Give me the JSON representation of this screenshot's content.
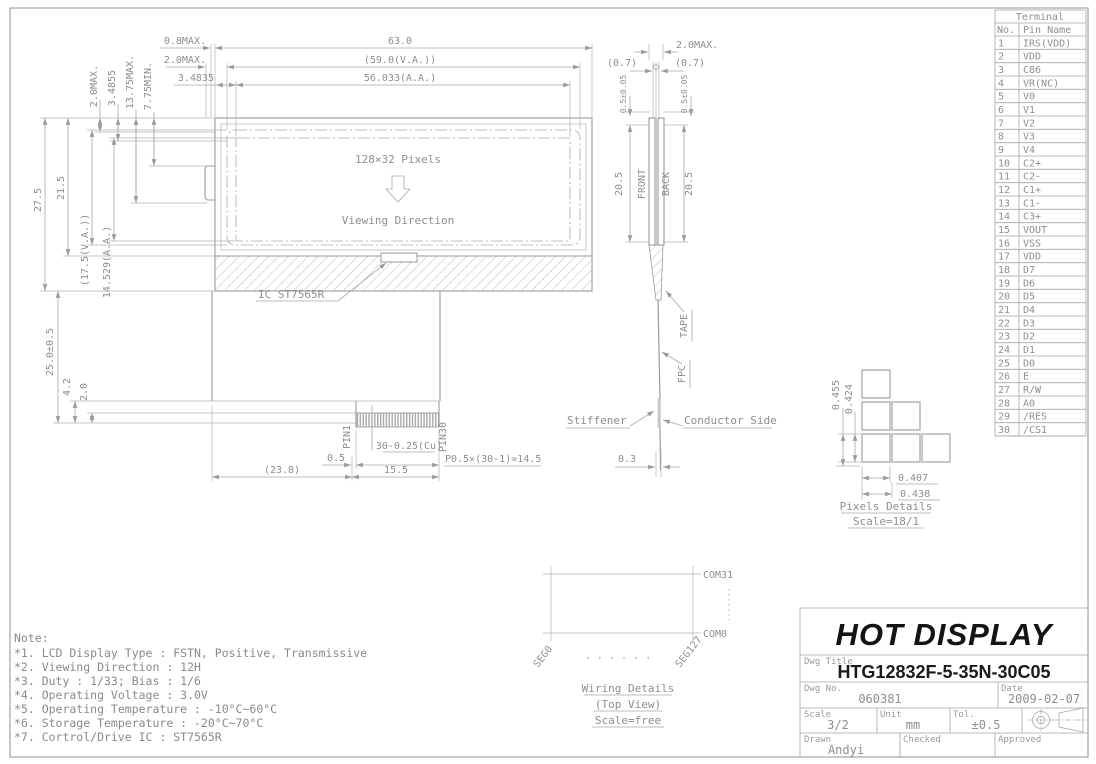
{
  "drawing": {
    "front_view": {
      "dims_top": {
        "overall": "63.0",
        "va": "(59.0(V.A.))",
        "aa": "56.033(A.A.)",
        "d08": "0.8MAX.",
        "d20": "2.0MAX.",
        "d34835": "3.4835"
      },
      "dims_left_top": {
        "d20max": "2.0MAX.",
        "d34855": "3.4855",
        "d1375": "13.75MAX.",
        "d775": "7.75MIN."
      },
      "dims_left": {
        "h275": "27.5",
        "h215": "21.5",
        "hva": "(17.5(V.A.))",
        "haa": "14.529(A.A.)",
        "h25": "25.0±0.5",
        "h42": "4.2",
        "h20": "2.0"
      },
      "display": {
        "pixels": "128×32 Pixels",
        "viewing": "Viewing Direction",
        "ic": "IC ST7565R"
      },
      "tail": {
        "pin1": "PIN1",
        "pin30": "PIN30",
        "cu": "30-0.25(Cu)",
        "d05": "0.5",
        "pitch": "P0.5×(30-1)=14.5",
        "d238": "(23.8)",
        "d155": "15.5"
      }
    },
    "side_view": {
      "d20max": "2.0MAX.",
      "d07l": "(0.7)",
      "d07r": "(0.7)",
      "d05l": "0.5±0.05",
      "d05r": "0.5±0.05",
      "front": "FRONT",
      "back": "BACK",
      "h205l": "20.5",
      "h205r": "20.5",
      "tape": "TAPE",
      "fpc": "FPC",
      "stiffener": "Stiffener",
      "conductor": "Conductor Side",
      "d03": "0.3"
    },
    "pixels_details": {
      "v1": "0.455",
      "v2": "0.424",
      "h1": "0.407",
      "h2": "0.438",
      "title": "Pixels Details",
      "scale": "Scale=18/1"
    },
    "wiring": {
      "com31": "COM31",
      "com0": "COM0",
      "seg0": "SEG0",
      "seg127": "SEG127",
      "dots": "· · · · · ·",
      "title": "Wiring Details",
      "subtitle": "(Top View)",
      "scale": "Scale=free"
    }
  },
  "terminal_table": {
    "title": "Terminal",
    "col_no": "No.",
    "col_pin": "Pin Name",
    "rows": [
      [
        "1",
        "IRS(VDD)"
      ],
      [
        "2",
        "VDD"
      ],
      [
        "3",
        "C86"
      ],
      [
        "4",
        "VR(NC)"
      ],
      [
        "5",
        "V0"
      ],
      [
        "6",
        "V1"
      ],
      [
        "7",
        "V2"
      ],
      [
        "8",
        "V3"
      ],
      [
        "9",
        "V4"
      ],
      [
        "10",
        "C2+"
      ],
      [
        "11",
        "C2-"
      ],
      [
        "12",
        "C1+"
      ],
      [
        "13",
        "C1-"
      ],
      [
        "14",
        "C3+"
      ],
      [
        "15",
        "VOUT"
      ],
      [
        "16",
        "VSS"
      ],
      [
        "17",
        "VDD"
      ],
      [
        "18",
        "D7"
      ],
      [
        "19",
        "D6"
      ],
      [
        "20",
        "D5"
      ],
      [
        "21",
        "D4"
      ],
      [
        "22",
        "D3"
      ],
      [
        "23",
        "D2"
      ],
      [
        "24",
        "D1"
      ],
      [
        "25",
        "D0"
      ],
      [
        "26",
        "E"
      ],
      [
        "27",
        "R/W"
      ],
      [
        "28",
        "A0"
      ],
      [
        "29",
        "/RES"
      ],
      [
        "30",
        "/CS1"
      ]
    ]
  },
  "notes": {
    "heading": "Note:",
    "lines": [
      "*1. LCD Display Type : FSTN, Positive, Transmissive",
      "*2. Viewing Direction : 12H",
      "*3. Duty : 1/33; Bias : 1/6",
      "*4. Operating Voltage : 3.0V",
      "*5. Operating Temperature : -10°C~60°C",
      "*6. Storage Temperature : -20°C~70°C",
      "*7. Cortrol/Drive IC : ST7565R"
    ]
  },
  "title_block": {
    "company": "HOT DISPLAY",
    "dwg_title_label": "Dwg Title",
    "dwg_title": "HTG12832F-5-35N-30C05",
    "dwg_no_label": "Dwg No.",
    "dwg_no": "060381",
    "date_label": "Date",
    "date": "2009-02-07",
    "scale_label": "Scale",
    "scale": "3/2",
    "unit_label": "Unit",
    "unit": "mm",
    "tol_label": "Tol.",
    "tol": "±0.5",
    "drawn_label": "Drawn",
    "drawn": "Andyi",
    "checked_label": "Checked",
    "approved_label": "Approved"
  },
  "colors": {
    "line": "#9a9a9a",
    "text": "#8e8e8e",
    "dark_text": "#1a1a1a"
  }
}
